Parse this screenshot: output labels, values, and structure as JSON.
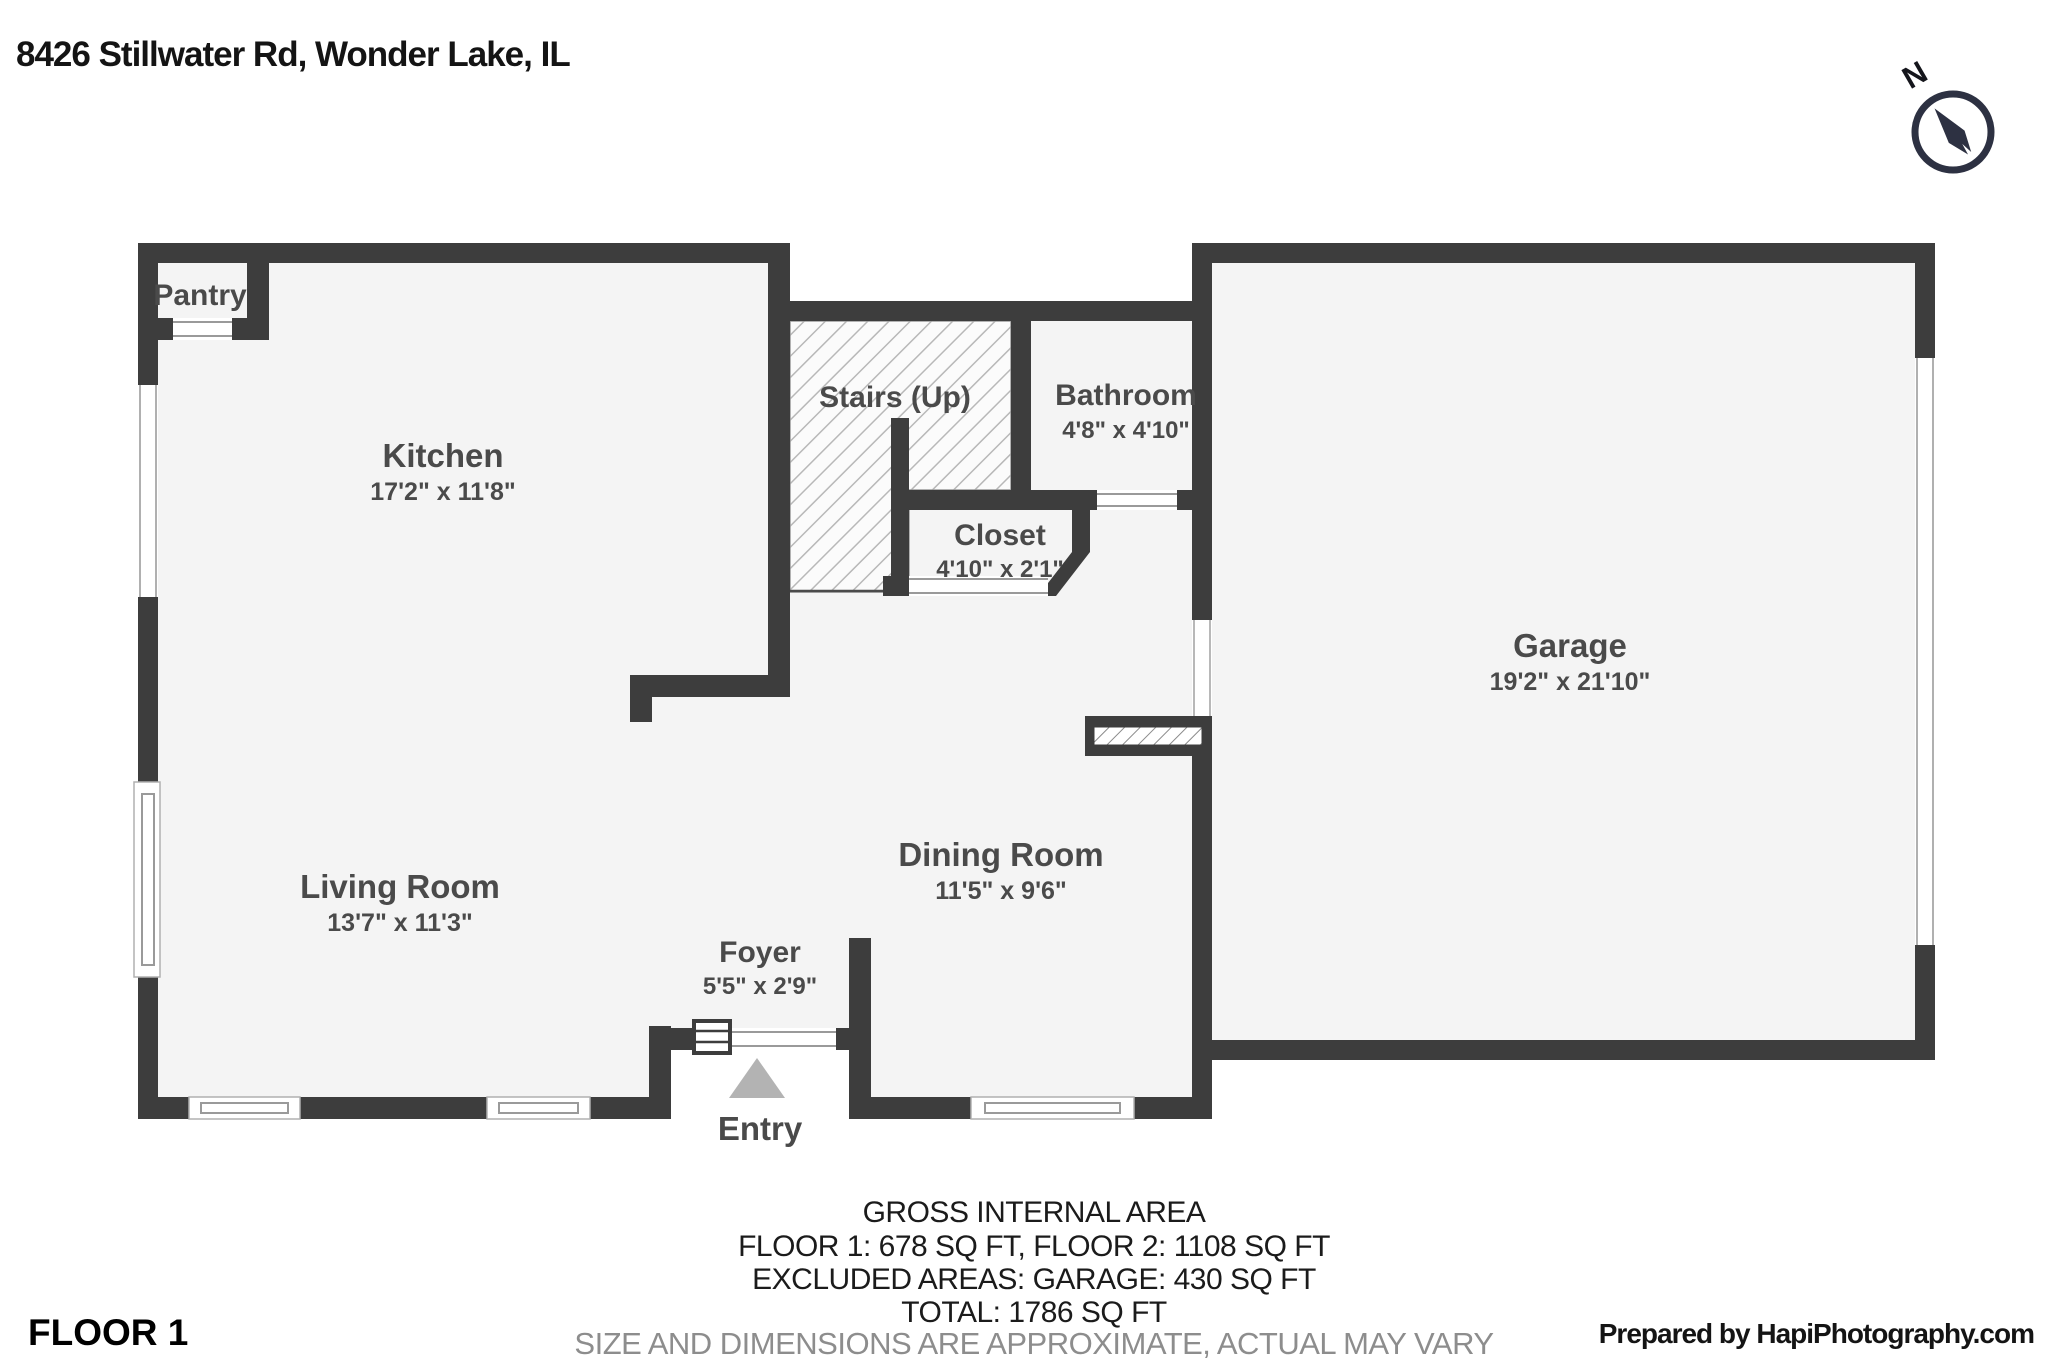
{
  "title": "8426 Stillwater Rd, Wonder Lake, IL",
  "compass": {
    "north_label": "N"
  },
  "rooms": {
    "pantry": {
      "name": "Pantry"
    },
    "kitchen": {
      "name": "Kitchen",
      "dims": "17'2\" x 11'8\""
    },
    "stairs": {
      "name": "Stairs (Up)"
    },
    "bathroom": {
      "name": "Bathroom",
      "dims": "4'8\" x 4'10\""
    },
    "closet": {
      "name": "Closet",
      "dims": "4'10\" x 2'1\""
    },
    "garage": {
      "name": "Garage",
      "dims": "19'2\" x 21'10\""
    },
    "living_room": {
      "name": "Living Room",
      "dims": "13'7\" x 11'3\""
    },
    "dining_room": {
      "name": "Dining Room",
      "dims": "11'5\" x 9'6\""
    },
    "foyer": {
      "name": "Foyer",
      "dims": "5'5\" x 2'9\""
    },
    "entry": {
      "name": "Entry"
    }
  },
  "summary": {
    "line1": "GROSS INTERNAL AREA",
    "line2": "FLOOR 1: 678 SQ FT, FLOOR 2: 1108 SQ FT",
    "line3": "EXCLUDED AREAS: GARAGE: 430 SQ FT",
    "line4": "TOTAL: 1786 SQ FT",
    "disclaimer": "SIZE AND DIMENSIONS ARE APPROXIMATE, ACTUAL MAY VARY"
  },
  "floor_label": "FLOOR 1",
  "credit": "Prepared by HapiPhotography.com",
  "colors": {
    "wall": "#3d3d3d",
    "floor": "#f4f4f4",
    "room_label": "#4a4a4a",
    "hatch_line": "#b8b8b8",
    "window_line": "#9a9a9a",
    "entry_arrow": "#b3b3b3",
    "compass": "#2d3142",
    "disclaimer_text": "#8d8d8d"
  }
}
